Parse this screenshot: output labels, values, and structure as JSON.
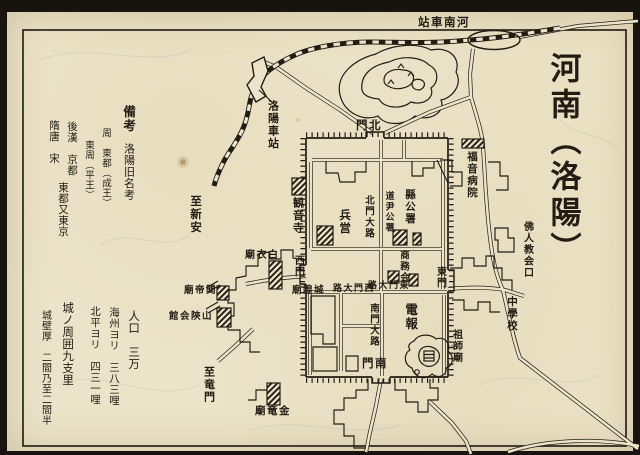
{
  "title": {
    "text": "河南（洛陽）"
  },
  "colors": {
    "paper": "#ece4c8",
    "ink": "#221c13"
  },
  "map_labels": [
    {
      "name": "station-henan-label",
      "text": "河南車站",
      "dir": "rtl",
      "x": 418,
      "y": 16,
      "size": 11.5
    },
    {
      "name": "station-luoyang-label",
      "text": "洛陽車站",
      "dir": "v",
      "x": 267,
      "y": 100,
      "size": 11
    },
    {
      "name": "to-xinan-label",
      "text": "至新安",
      "dir": "v",
      "x": 190,
      "y": 195,
      "size": 11.5
    },
    {
      "name": "kannonji-temple-label",
      "text": "観音寺",
      "dir": "v",
      "x": 292,
      "y": 197,
      "size": 11
    },
    {
      "name": "gospel-hospital-label",
      "text": "福音病院",
      "dir": "v",
      "x": 466,
      "y": 151,
      "size": 10.5
    },
    {
      "name": "north-gate-label",
      "text": "北門",
      "dir": "rtl",
      "x": 356,
      "y": 119,
      "size": 11.5
    },
    {
      "name": "west-gate-label",
      "text": "西門",
      "dir": "v",
      "x": 292,
      "y": 255,
      "size": 10
    },
    {
      "name": "east-gate-label",
      "text": "東門",
      "dir": "v",
      "x": 434,
      "y": 266,
      "size": 10
    },
    {
      "name": "south-gate-label",
      "text": "南門",
      "dir": "rtl",
      "x": 362,
      "y": 357,
      "size": 11.5
    },
    {
      "name": "north-gate-avenue-label",
      "text": "北門大路",
      "dir": "v",
      "x": 363,
      "y": 195,
      "size": 9.5
    },
    {
      "name": "west-gate-avenue-label",
      "text": "西門大路",
      "dir": "rtl",
      "x": 333,
      "y": 285,
      "size": 9
    },
    {
      "name": "east-gate-avenue-label",
      "text": "東門大路",
      "dir": "rtl",
      "x": 368,
      "y": 282,
      "size": 9
    },
    {
      "name": "south-gate-avenue-label",
      "text": "南門大路",
      "dir": "v",
      "x": 368,
      "y": 303,
      "size": 9.5
    },
    {
      "name": "barracks-label",
      "text": "兵営",
      "dir": "v",
      "x": 339,
      "y": 209,
      "size": 11.5
    },
    {
      "name": "intendant-office-label",
      "text": "道尹公署",
      "dir": "v",
      "x": 383,
      "y": 191,
      "size": 9
    },
    {
      "name": "county-office-label",
      "text": "縣公署",
      "dir": "v",
      "x": 404,
      "y": 189,
      "size": 10.5
    },
    {
      "name": "chamber-of-commerce-label",
      "text": "商務会",
      "dir": "v",
      "x": 398,
      "y": 250,
      "size": 9.5
    },
    {
      "name": "telegraph-office-label",
      "text": "電報",
      "dir": "v",
      "x": 404,
      "y": 303,
      "size": 12.5
    },
    {
      "name": "soshi-temple-label",
      "text": "祖師廟",
      "dir": "v",
      "x": 450,
      "y": 329,
      "size": 10
    },
    {
      "name": "french-church-label",
      "text": "佛人教会口",
      "dir": "v",
      "x": 521,
      "y": 221,
      "size": 10
    },
    {
      "name": "middle-school-label",
      "text": "中學校",
      "dir": "v",
      "x": 506,
      "y": 296,
      "size": 10.5
    },
    {
      "name": "chenghuang-temple-label",
      "text": "城隍廟",
      "dir": "rtl",
      "x": 292,
      "y": 286,
      "size": 9.5
    },
    {
      "name": "baiyi-temple-label",
      "text": "白衣廟",
      "dir": "rtl",
      "x": 245,
      "y": 251,
      "size": 10
    },
    {
      "name": "guandi-temple-label",
      "text": "関帝廟",
      "dir": "rtl",
      "x": 184,
      "y": 286,
      "size": 9.5
    },
    {
      "name": "shanshan-hall-label",
      "text": "山陝会館",
      "dir": "rtl",
      "x": 169,
      "y": 312,
      "size": 9.5
    },
    {
      "name": "to-longmen-label",
      "text": "至竜門",
      "dir": "v",
      "x": 203,
      "y": 366,
      "size": 11
    },
    {
      "name": "jinlong-temple-label",
      "text": "金竜廟",
      "dir": "rtl",
      "x": 255,
      "y": 406,
      "size": 10.5
    },
    {
      "name": "remarks-title",
      "text": "備考",
      "dir": "v",
      "x": 122,
      "y": 105,
      "size": 12.5
    },
    {
      "name": "remarks-subtitle",
      "text": "洛陽旧名考",
      "dir": "v",
      "x": 123,
      "y": 143,
      "size": 11,
      "cls": "note"
    },
    {
      "name": "note-zhou",
      "text": "周　東都（成王）",
      "dir": "v",
      "x": 100,
      "y": 128,
      "size": 9.5,
      "cls": "note"
    },
    {
      "name": "note-dongzhou",
      "text": "東周（平王）",
      "dir": "v",
      "x": 83,
      "y": 140,
      "size": 9.5,
      "cls": "note"
    },
    {
      "name": "note-gokan",
      "text": "後漢　京都",
      "dir": "v",
      "x": 66,
      "y": 121,
      "size": 10.5,
      "cls": "note"
    },
    {
      "name": "note-zuito",
      "text": "隋唐　宋",
      "dir": "v",
      "x": 48,
      "y": 120,
      "size": 10.5,
      "cls": "note"
    },
    {
      "name": "note-todo",
      "text": "東都又東京",
      "dir": "v",
      "x": 57,
      "y": 182,
      "size": 10.5,
      "cls": "note"
    },
    {
      "name": "population",
      "text": "人口　三万",
      "dir": "v",
      "x": 128,
      "y": 310,
      "size": 11.5,
      "cls": "note"
    },
    {
      "name": "dist-haizhou",
      "text": "海州ヨリ　三八三哩",
      "dir": "v",
      "x": 108,
      "y": 307,
      "size": 10.5,
      "cls": "note"
    },
    {
      "name": "dist-beiping",
      "text": "北平ヨリ　四三一哩",
      "dir": "v",
      "x": 89,
      "y": 306,
      "size": 10.5,
      "cls": "note"
    },
    {
      "name": "city-circumference",
      "text": "城ノ周囲九支里",
      "dir": "v",
      "x": 62,
      "y": 302,
      "size": 11.5,
      "cls": "note"
    },
    {
      "name": "wall-thickness",
      "text": "城壁厚　二間乃至二間半",
      "dir": "v",
      "x": 39,
      "y": 310,
      "size": 10,
      "cls": "note"
    }
  ]
}
